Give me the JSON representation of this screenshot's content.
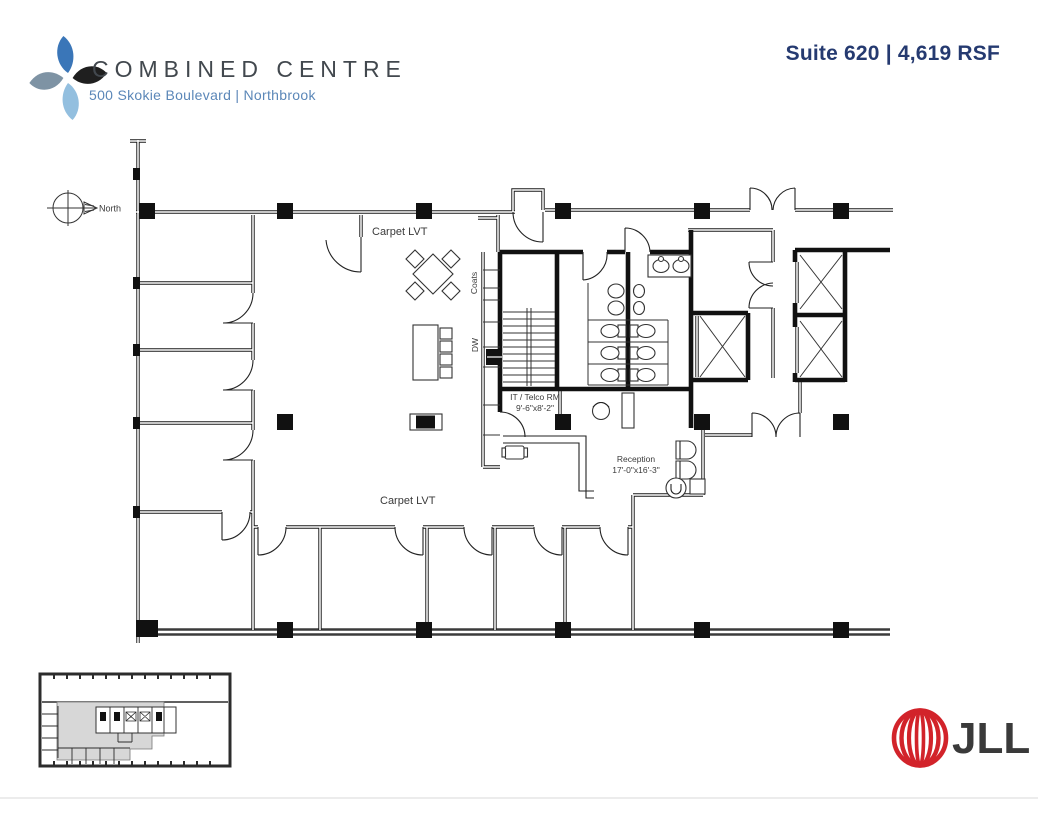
{
  "header": {
    "building_name": "COMBINED CENTRE",
    "address": "500 Skokie Boulevard | Northbrook",
    "suite_label": "Suite 620 | 4,619 RSF"
  },
  "plan": {
    "north_label": "North",
    "finish_label_top": "Carpet LVT",
    "finish_label_bottom": "Carpet LVT",
    "coats_label": "Coats",
    "dishwasher_label": "DW",
    "it_room": {
      "name": "IT / Telco RM",
      "dimensions": "9'-6\"x8'-2\""
    },
    "reception": {
      "name": "Reception",
      "dimensions": "17'-0\"x16'-3\""
    }
  },
  "footer": {
    "jll_wordmark": "JLL"
  },
  "colors": {
    "brand_navy": "#253a70",
    "address_blue": "#5b87b8",
    "jll_red": "#d2232a",
    "logo_blue": "#3a76b8",
    "logo_light_blue": "#93bfdf",
    "logo_slate": "#7e93a4",
    "logo_black": "#1f1f1f",
    "keyplan_highlight": "#d7d7d7"
  }
}
